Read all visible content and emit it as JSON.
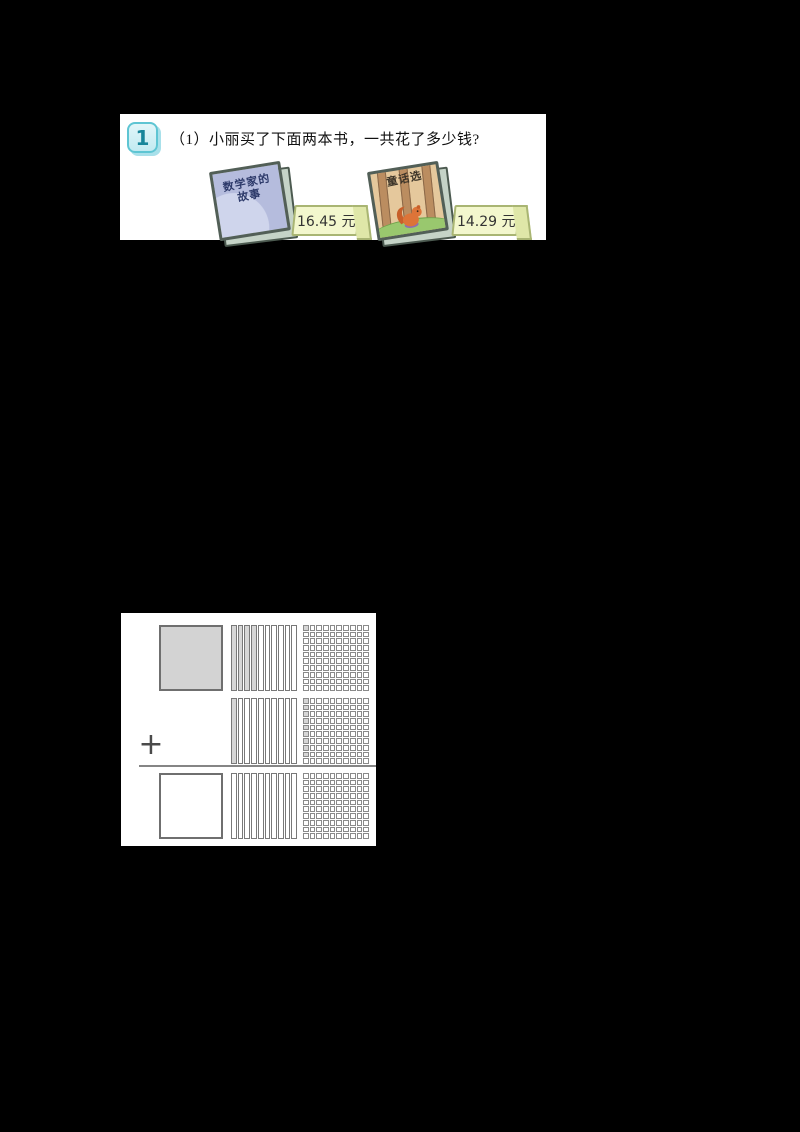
{
  "colors": {
    "canvas_bg": "#000000",
    "panel_bg": "#ffffff",
    "badge_fill": "#c9edf3",
    "badge_border": "#5ec5d3",
    "badge_text_color": "#17859a",
    "price_tag_fill": "#f3f7cd",
    "price_tag_border": "#a9b573",
    "shade_fill": "#d6d6d6",
    "grid_line": "#8a8a8a"
  },
  "problem": {
    "badge": "1",
    "question": "（1）小丽买了下面两本书，一共花了多少钱?",
    "books": [
      {
        "title_line1": "数学家的",
        "title_line2": "故事",
        "price": "16.45 元"
      },
      {
        "title_line1": "童话选",
        "title_line2": "",
        "price": "14.29 元"
      }
    ]
  },
  "model": {
    "operator": "+",
    "description": "place-value shading model: whole square, tenths strips (10), hundredths grid (10x10); shading fills column-first from top-left",
    "rows": [
      {
        "name": "addend-1",
        "whole": "filled",
        "tenths_shaded": 4,
        "hundredths_shaded": 1
      },
      {
        "name": "addend-2",
        "whole": "none",
        "tenths_shaded": 1,
        "hundredths_shaded": 9
      },
      {
        "name": "sum",
        "whole": "empty",
        "tenths_shaded": 0,
        "hundredths_shaded": 0
      }
    ]
  }
}
